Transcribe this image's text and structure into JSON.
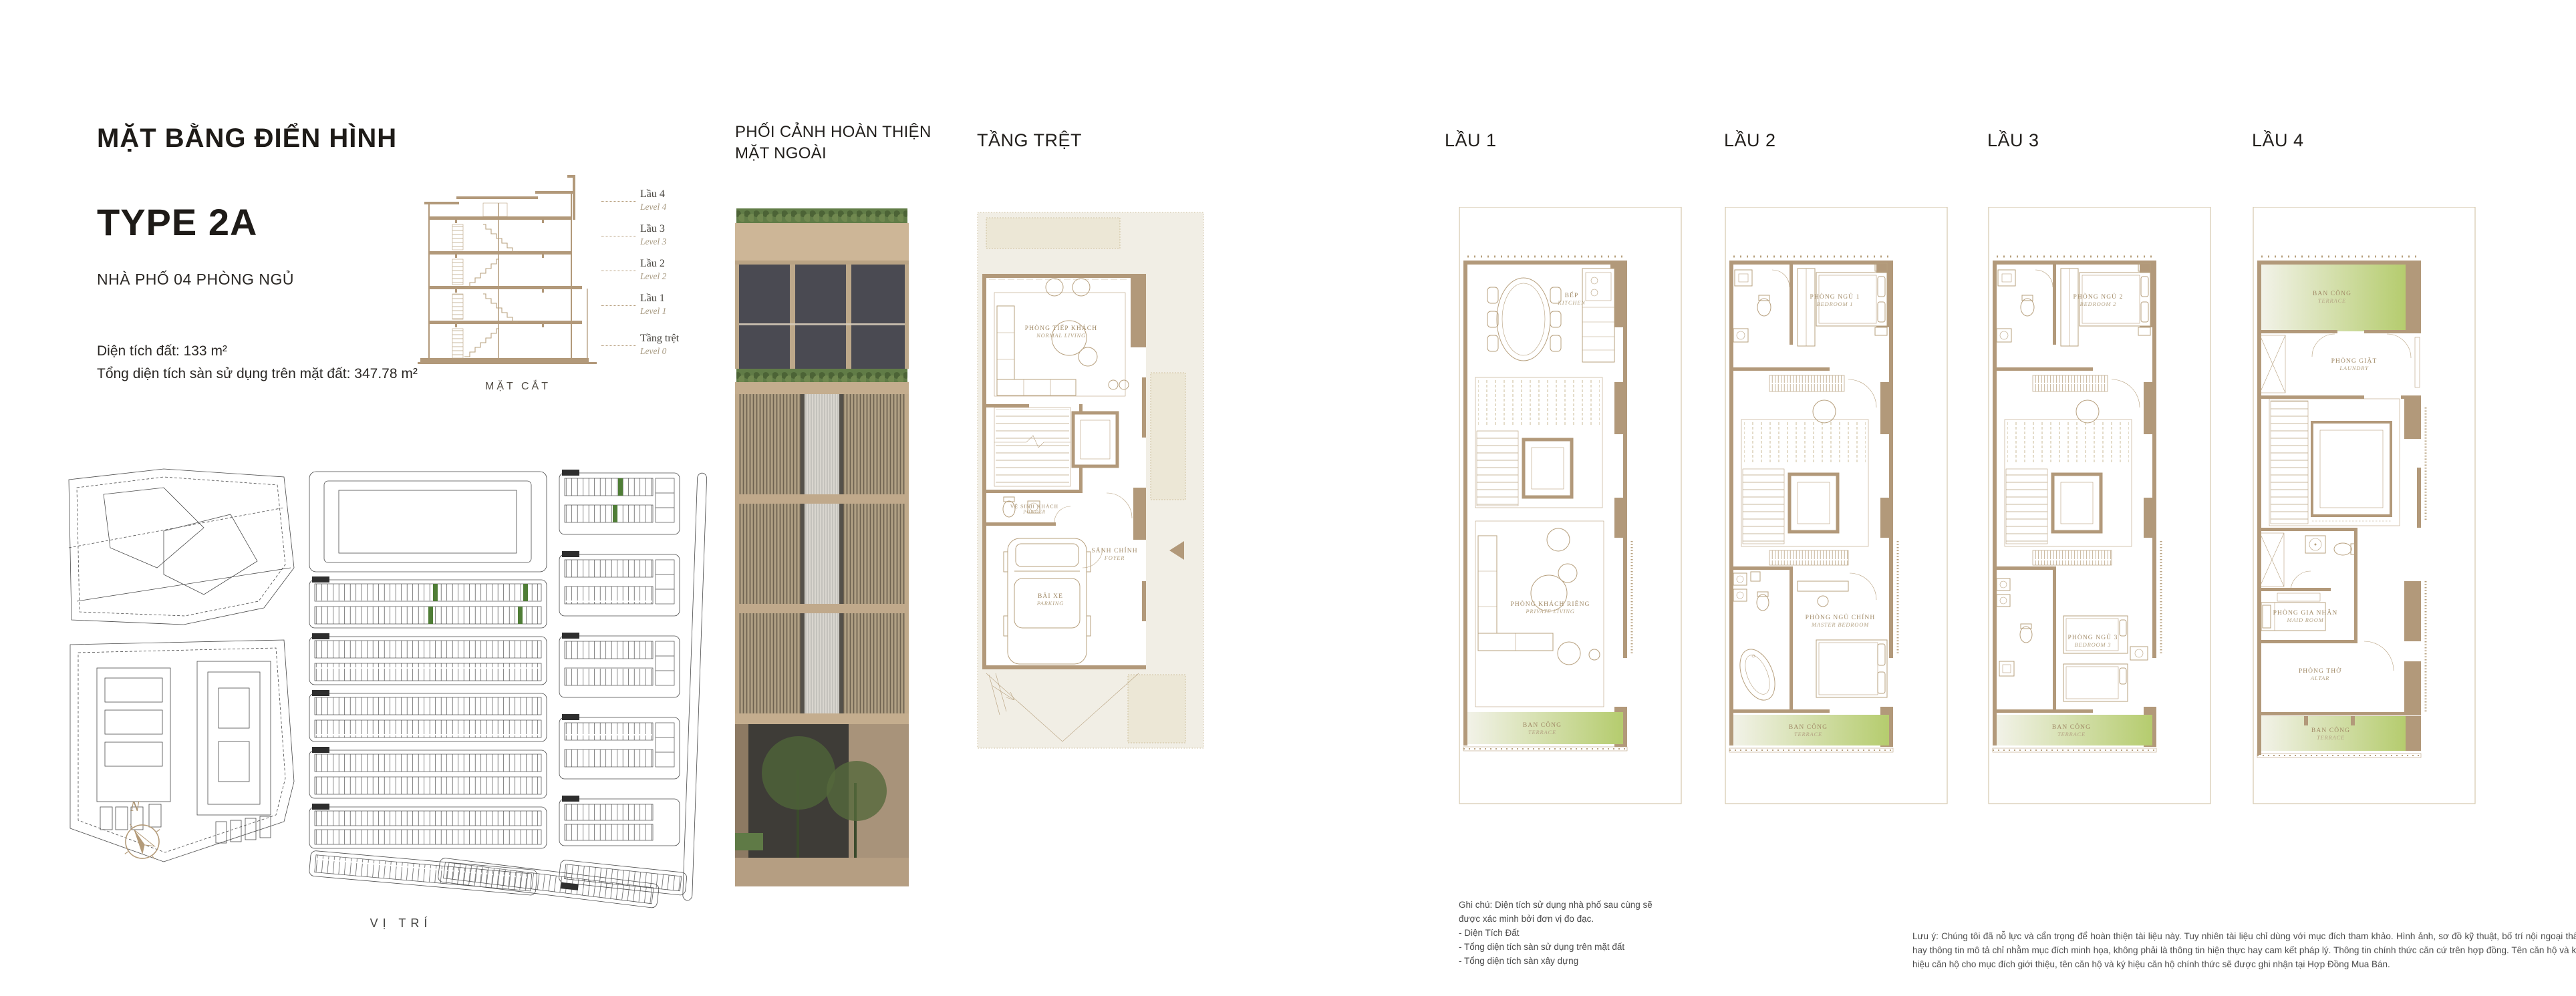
{
  "info": {
    "title": "MẶT BẰNG ĐIỂN HÌNH",
    "type_name": "TYPE 2A",
    "subtitle": "NHÀ PHỐ 04 PHÒNG NGỦ",
    "area_line1": "Diện tích đất: 133 m²",
    "area_line2": "Tổng diện tích sàn sử dụng trên mặt đất: 347.78 m²"
  },
  "section": {
    "title": "MẶT CẮT",
    "levels": [
      {
        "vi": "Lầu 4",
        "en": "Level 4"
      },
      {
        "vi": "Lầu 3",
        "en": "Level 3"
      },
      {
        "vi": "Lầu 2",
        "en": "Level 2"
      },
      {
        "vi": "Lầu 1",
        "en": "Level 1"
      },
      {
        "vi": "Tầng trệt",
        "en": "Level 0"
      }
    ]
  },
  "site": {
    "label": "VỊ TRÍ",
    "compass_n": "N"
  },
  "elevation": {
    "header": "PHỐI CẢNH HOÀN THIỆN\nMẶT NGOÀI"
  },
  "plans": [
    {
      "title": "TẦNG TRỆT",
      "rooms": [
        {
          "vi": "PHÒNG TIẾP KHÁCH",
          "en": "NORMAL LIVING"
        },
        {
          "vi": "VỆ SINH KHÁCH",
          "en": "POWDER"
        },
        {
          "vi": "SẢNH CHÍNH",
          "en": "FOYER"
        },
        {
          "vi": "BÃI XE",
          "en": "PARKING"
        }
      ]
    },
    {
      "title": "LẦU 1",
      "rooms": [
        {
          "vi": "BẾP",
          "en": "KITCHEN"
        },
        {
          "vi": "PHÒNG KHÁCH RIÊNG",
          "en": "PRIVATE LIVING"
        },
        {
          "vi": "BAN CÔNG",
          "en": "TERRACE"
        }
      ]
    },
    {
      "title": "LẦU 2",
      "rooms": [
        {
          "vi": "PHÒNG NGỦ 1",
          "en": "BEDROOM 1"
        },
        {
          "vi": "PHÒNG NGỦ CHÍNH",
          "en": "MASTER BEDROOM"
        },
        {
          "vi": "BAN CÔNG",
          "en": "TERRACE"
        }
      ]
    },
    {
      "title": "LẦU 3",
      "rooms": [
        {
          "vi": "PHÒNG NGỦ 2",
          "en": "BEDROOM 2"
        },
        {
          "vi": "PHÒNG NGỦ 3",
          "en": "BEDROOM 3"
        },
        {
          "vi": "BAN CÔNG",
          "en": "TERRACE"
        }
      ]
    },
    {
      "title": "LẦU 4",
      "rooms": [
        {
          "vi": "BAN CÔNG",
          "en": "TERRACE"
        },
        {
          "vi": "PHÒNG GIẶT",
          "en": "LAUNDRY"
        },
        {
          "vi": "PHÒNG GIA NHÂN",
          "en": "MAID ROOM"
        },
        {
          "vi": "PHÒNG THỜ",
          "en": "ALTAR"
        },
        {
          "vi": "BAN CÔNG",
          "en": "TERRACE"
        }
      ]
    }
  ],
  "notes": {
    "ghi_chu": "Ghi chú: Diện tích sử dụng nhà phố sau cùng sẽ\nđược xác minh bởi đơn vị đo đạc.\n- Diện Tích Đất\n- Tổng diện tích sàn sử dụng trên mặt đất\n- Tổng diện tích sàn xây dựng",
    "luu_y": "Lưu ý: Chúng tôi đã nỗ lực và cẩn trọng để hoàn thiện tài liệu này. Tuy nhiên tài liệu chỉ dùng với mục đích tham khảo. Hình ảnh, sơ đồ kỹ thuật, bố trí nội ngoại thất hay thông tin mô tả chỉ nhằm mục đích minh họa, không phải là thông tin hiện thực hay cam kết pháp lý. Thông tin chính thức căn cứ trên hợp đồng. Tên căn hộ và ký hiệu căn hộ cho mục đích giới thiệu, tên căn hộ và ký hiệu căn hộ chính thức sẽ được ghi nhận tại Hợp Đồng Mua Bán."
  },
  "colors": {
    "wall_tan": "#b2997a",
    "line_tan": "#b7a07e",
    "beige": "#f1eee5",
    "terrace_green": "#b5cc6e",
    "lot_green": "#4f7d36",
    "text_dark": "#221f1c",
    "label_tan": "#a18a67"
  }
}
